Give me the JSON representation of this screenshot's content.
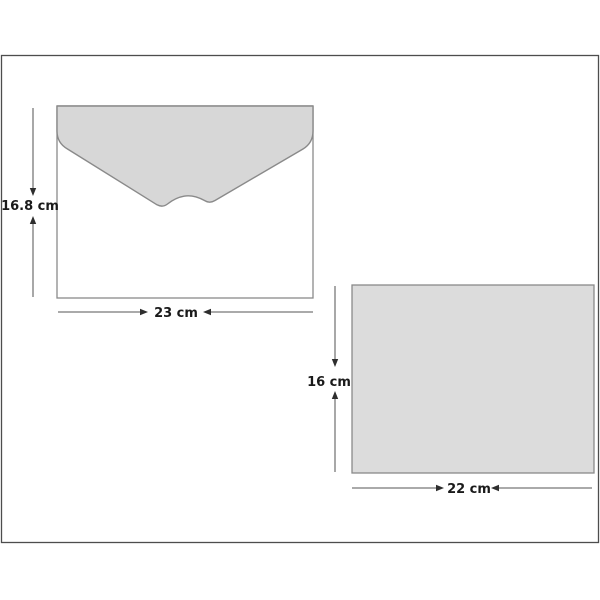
{
  "diagram": {
    "description": "Geometry diagram of an envelope and a rectangular card with labeled dimensions",
    "envelope": {
      "shape": "envelope-with-flap",
      "height_label": "16.8 cm",
      "width_label": "23 cm",
      "height_value_cm": 16.8,
      "width_value_cm": 23
    },
    "card": {
      "shape": "rectangle",
      "height_label": "16 cm",
      "width_label": "22 cm",
      "height_value_cm": 16,
      "width_value_cm": 22
    },
    "colors": {
      "background": "#ffffff",
      "frame_border": "#4d4d4d",
      "shape_stroke": "#8a8a8a",
      "flap_fill": "#d7d7d7",
      "envelope_body_fill": "#ffffff",
      "card_fill": "#dcdcdc",
      "dim_line": "#787878",
      "arrow_fill": "#2e2e2e",
      "text_color": "#1a1a1a"
    }
  }
}
